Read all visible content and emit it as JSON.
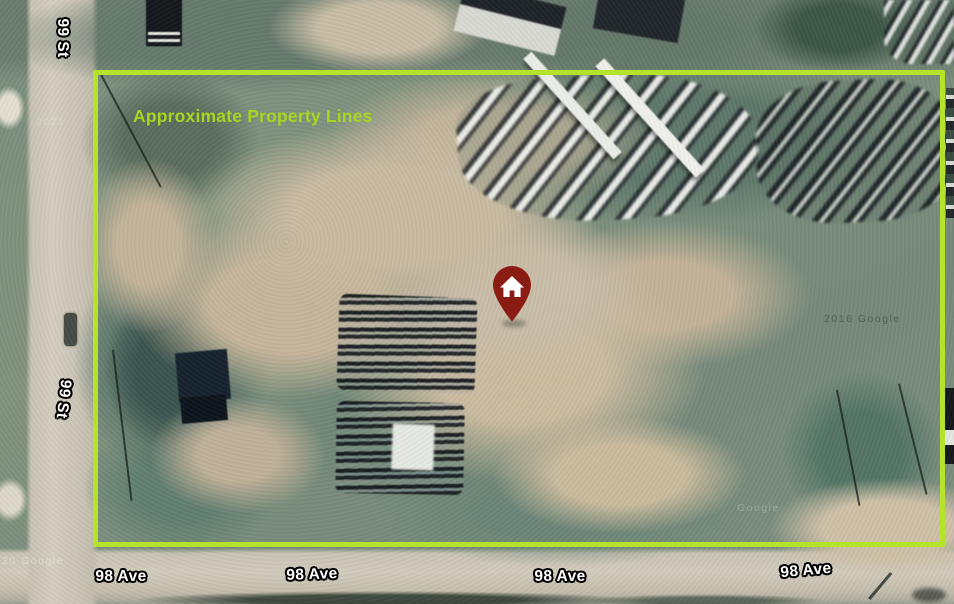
{
  "scene": {
    "type": "satellite-map-annotation",
    "description": "Aerial satellite view of a vacant industrial lot with annotated property boundary",
    "property_label": "Approximate Property Lines",
    "colors": {
      "property_line": "#b5e32b",
      "label_text": "#a8d51f",
      "pin": "#8b1c14",
      "street_label_text": "#ffffff",
      "street_label_outline": "#000000"
    },
    "pin": {
      "icon": "home-pin",
      "color": "#8b1c14",
      "glyph": "house"
    }
  },
  "streets": {
    "vertical": [
      {
        "label": "99 St"
      },
      {
        "label": "99 St"
      }
    ],
    "horizontal": [
      {
        "label": "98 Ave"
      },
      {
        "label": "98 Ave"
      },
      {
        "label": "98 Ave"
      },
      {
        "label": "98 Ave"
      }
    ]
  },
  "watermarks": [
    {
      "text": "2021"
    },
    {
      "text": "2016 Google"
    },
    {
      "text": "Google"
    },
    {
      "text": "20 Google"
    }
  ]
}
